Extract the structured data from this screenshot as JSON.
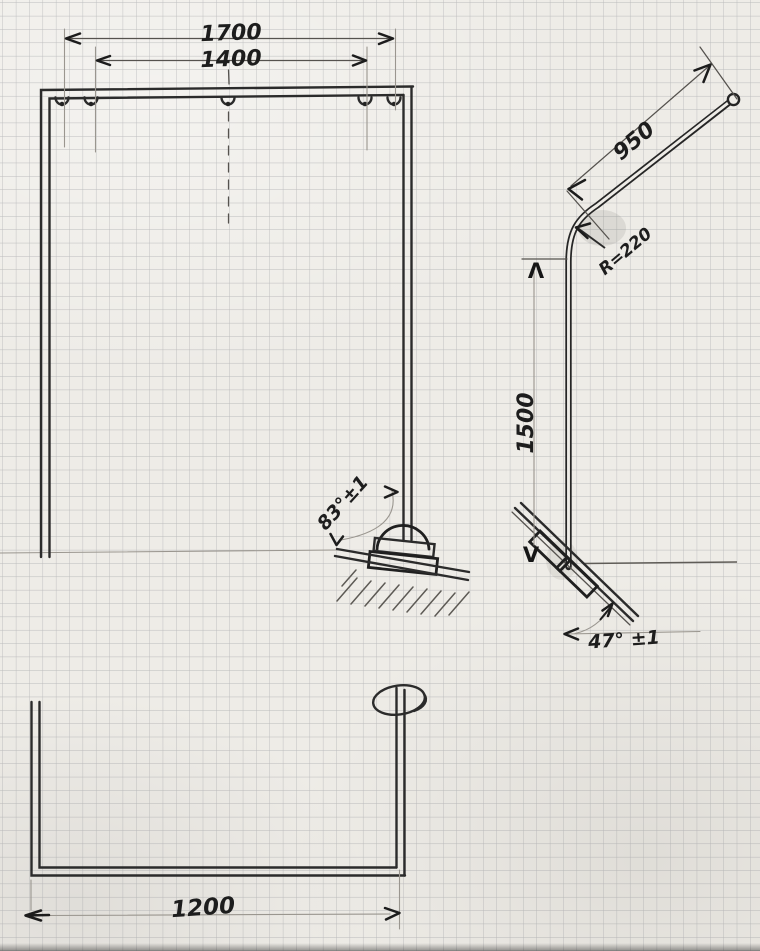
{
  "document": {
    "kind": "hand-drawn technical sketch",
    "medium": "pencil on squared graph paper",
    "subject": "bent tubular frame (goal-type frame) in three views"
  },
  "colors": {
    "paper": "#eeece7",
    "grid": "#8f9196",
    "pencil": "#2b2b2b"
  },
  "front_view": {
    "dim_outer_width": "1700",
    "dim_inner_width": "1400",
    "base_angle": "83°±1"
  },
  "side_view": {
    "dim_pole_height": "1500",
    "dim_arm_length": "950",
    "bend_radius": "R=220",
    "base_angle": "47° ±1",
    "marker_top": "Λ",
    "marker_bottom": "V"
  },
  "bottom_view": {
    "dim_depth": "1200"
  }
}
